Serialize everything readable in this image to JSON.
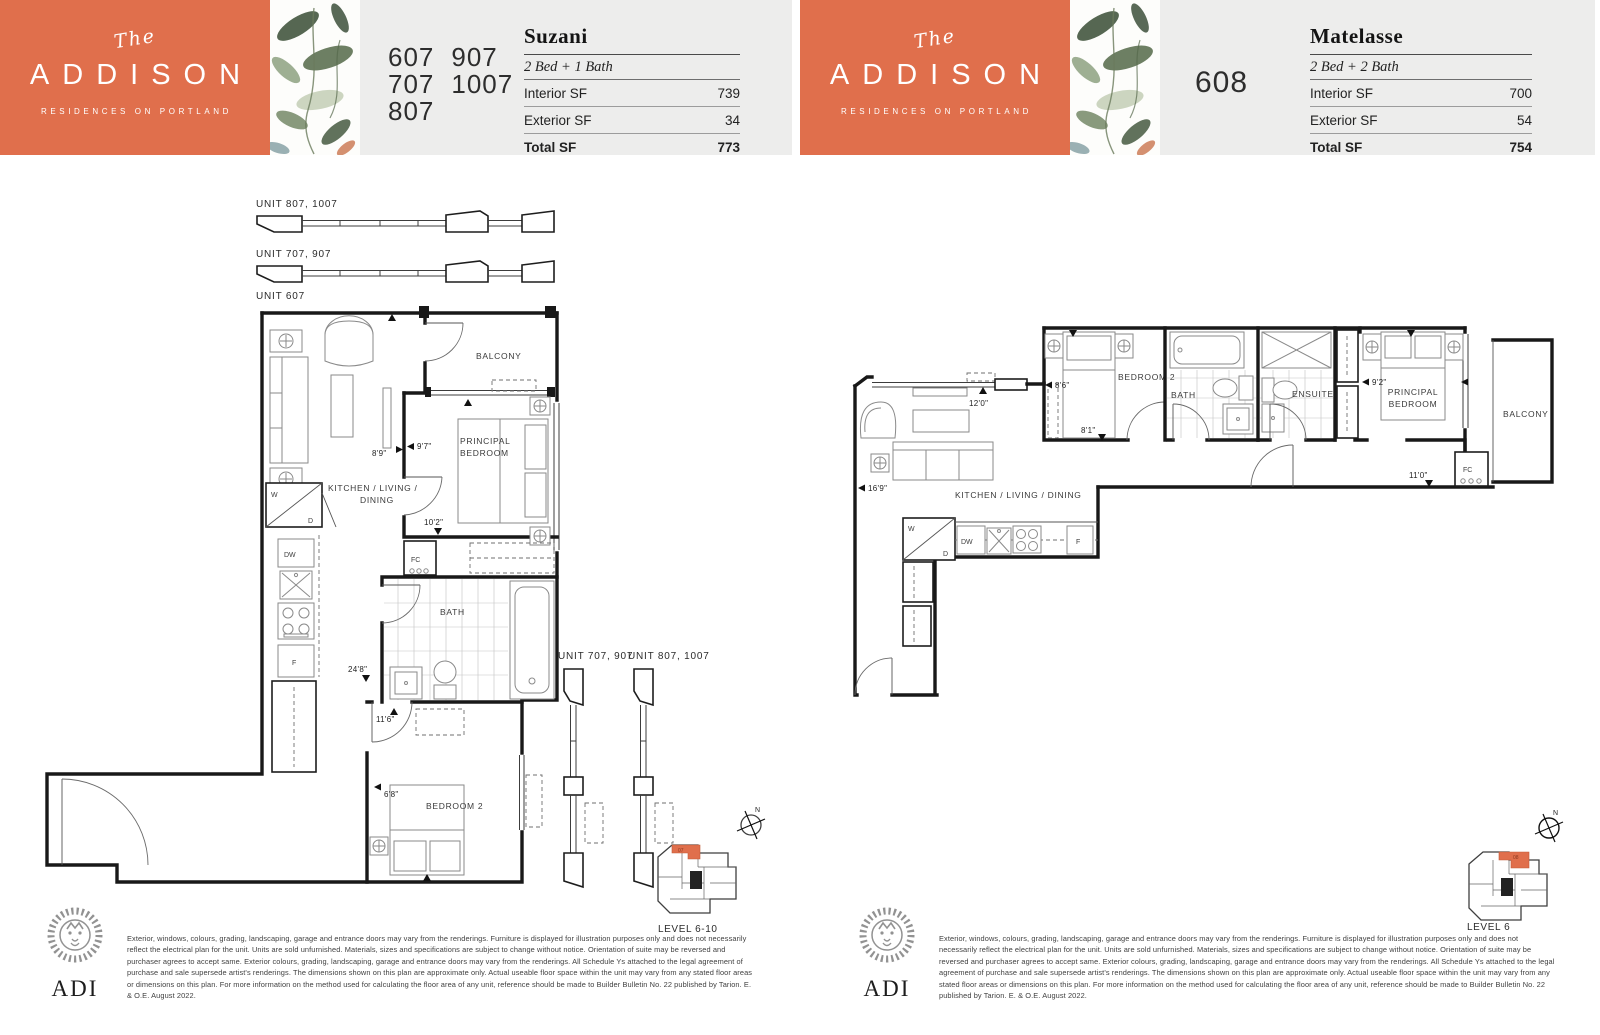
{
  "brand": {
    "pre": "The",
    "name": "ADDISON",
    "tagline": "RESIDENCES ON PORTLAND"
  },
  "pages": {
    "left": {
      "units_col1": [
        "607",
        "707",
        "807"
      ],
      "units_col2": [
        "907",
        "1007"
      ],
      "plan_name": "Suzani",
      "plan_type": "2 Bed + 1 Bath",
      "specs": [
        {
          "label": "Interior SF",
          "value": "739"
        },
        {
          "label": "Exterior SF",
          "value": "34"
        },
        {
          "label": "Total SF",
          "value": "773"
        }
      ]
    },
    "right": {
      "unit": "608",
      "plan_name": "Matelasse",
      "plan_type": "2 Bed + 2 Bath",
      "specs": [
        {
          "label": "Interior SF",
          "value": "700"
        },
        {
          "label": "Exterior SF",
          "value": "54"
        },
        {
          "label": "Total SF",
          "value": "754"
        }
      ]
    }
  },
  "lp": {
    "strip_a": "UNIT 807, 1007",
    "strip_b": "UNIT 707, 907",
    "unit_main": "UNIT 607",
    "balcony": "BALCONY",
    "principal_1": "PRINCIPAL",
    "principal_2": "BEDROOM",
    "kld_1": "KITCHEN / LIVING /",
    "kld_2": "DINING",
    "bath": "BATH",
    "bed2": "BEDROOM 2",
    "side_a": "UNIT 707, 907",
    "side_b": "UNIT 807, 1007",
    "d_89": "8'9\"",
    "d_97": "9'7\"",
    "d_102": "10'2\"",
    "d_248": "24'8\"",
    "d_116": "11'6\"",
    "d_68": "6'8\"",
    "w": "W",
    "d": "D",
    "dw": "DW",
    "f": "F",
    "fc": "FC",
    "key_unit": "07",
    "key_level": "LEVEL 6-10",
    "north": "N"
  },
  "rp": {
    "bed2": "BEDROOM 2",
    "bath": "BATH",
    "ensuite": "ENSUITE",
    "principal_1": "PRINCIPAL",
    "principal_2": "BEDROOM",
    "balcony": "BALCONY",
    "kld": "KITCHEN / LIVING / DINING",
    "d_120": "12'0\"",
    "d_169": "16'9\"",
    "d_86": "8'6\"",
    "d_81": "8'1\"",
    "d_92": "9'2\"",
    "d_110": "11'0\"",
    "w": "W",
    "d": "D",
    "dw": "DW",
    "f": "F",
    "fc": "FC",
    "key_unit": "08",
    "key_level": "LEVEL 6",
    "north": "N"
  },
  "footer": {
    "adi": "ADI",
    "disclaimer": "Exterior, windows, colours, grading, landscaping, garage and entrance doors may vary from the renderings. Furniture is displayed for illustration purposes only and does not necessarily reflect the electrical plan for the unit. Units are sold unfurnished. Materials, sizes and specifications are subject to change without notice. Orientation of suite may be reversed and purchaser agrees to accept same. Exterior colours, grading, landscaping, garage and entrance doors may vary from the renderings. All Schedule Ys attached to the legal agreement of purchase and sale supersede artist's renderings. The dimensions shown on this plan are approximate only. Actual useable floor space within the unit may vary from any stated floor areas or dimensions on this plan. For more information on the method used for calculating the floor area of any unit, reference should be made to Builder Bulletin No. 22 published by Tarion. E. & O.E. August 2022."
  },
  "colors": {
    "accent": "#E06F4C",
    "header_bg": "#EDEDEC",
    "wall": "#181818"
  }
}
